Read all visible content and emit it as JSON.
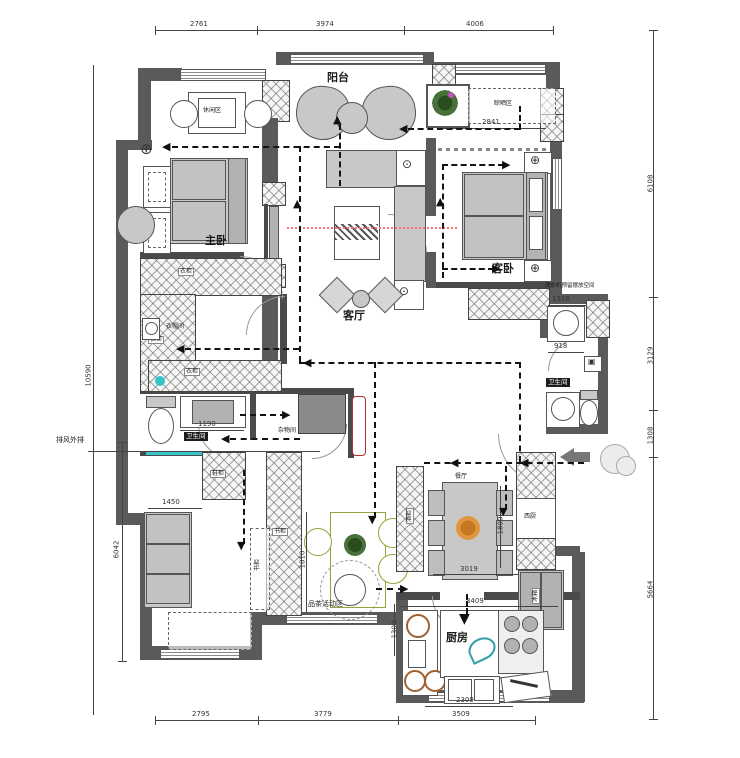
{
  "rooms": {
    "balcony": "阳台",
    "leisure_zone": "休闲区",
    "drying_zone": "晾晒区",
    "master_bedroom": "主卧",
    "guest_bedroom": "客卧",
    "living_room": "客厅",
    "wardrobe": "衣柜",
    "cloakroom": "衣帽间",
    "bathroom": "卫生间",
    "storage_room": "杂物间",
    "shoe_cabinet": "鞋柜",
    "bookcase": "书柜",
    "tea_activity_zone": "品茶活动区",
    "dining_room": "餐厅",
    "wine_cabinet": "酒柜",
    "west_kitchen": "西厨",
    "fridge": "冰箱",
    "kitchen": "厨房"
  },
  "annotations": {
    "exhaust": "排风外排",
    "washer_space": "洗衣机预留摆放空间"
  },
  "dims": {
    "top": [
      "2761",
      "3974",
      "4006"
    ],
    "bottom": [
      "2795",
      "3779",
      "3509"
    ],
    "right": [
      "6108",
      "3129",
      "1308",
      "5664"
    ],
    "left_outer": "10590",
    "left_inner": "6042",
    "drying_width": "2841",
    "washer_width": "1318",
    "bath_right_width": "918",
    "bath_left_width": "1190",
    "sofa_width": "1450",
    "tea_height": "1810",
    "kitchen_left_height": "1300",
    "dining_width": "3019",
    "dining_height": "1800",
    "kitchen_top_width": "3409",
    "kitchen_width": "2309"
  },
  "colors": {
    "wall": "#5a5a5a",
    "furniture": "#c8c8c8",
    "flow_line": "#141414",
    "sight_line": "#ff7070",
    "teal_accent": "#35c4c8",
    "red_accent": "#b03030",
    "tea_accent": "#9aa03a",
    "flower_accent": "#c87820"
  }
}
